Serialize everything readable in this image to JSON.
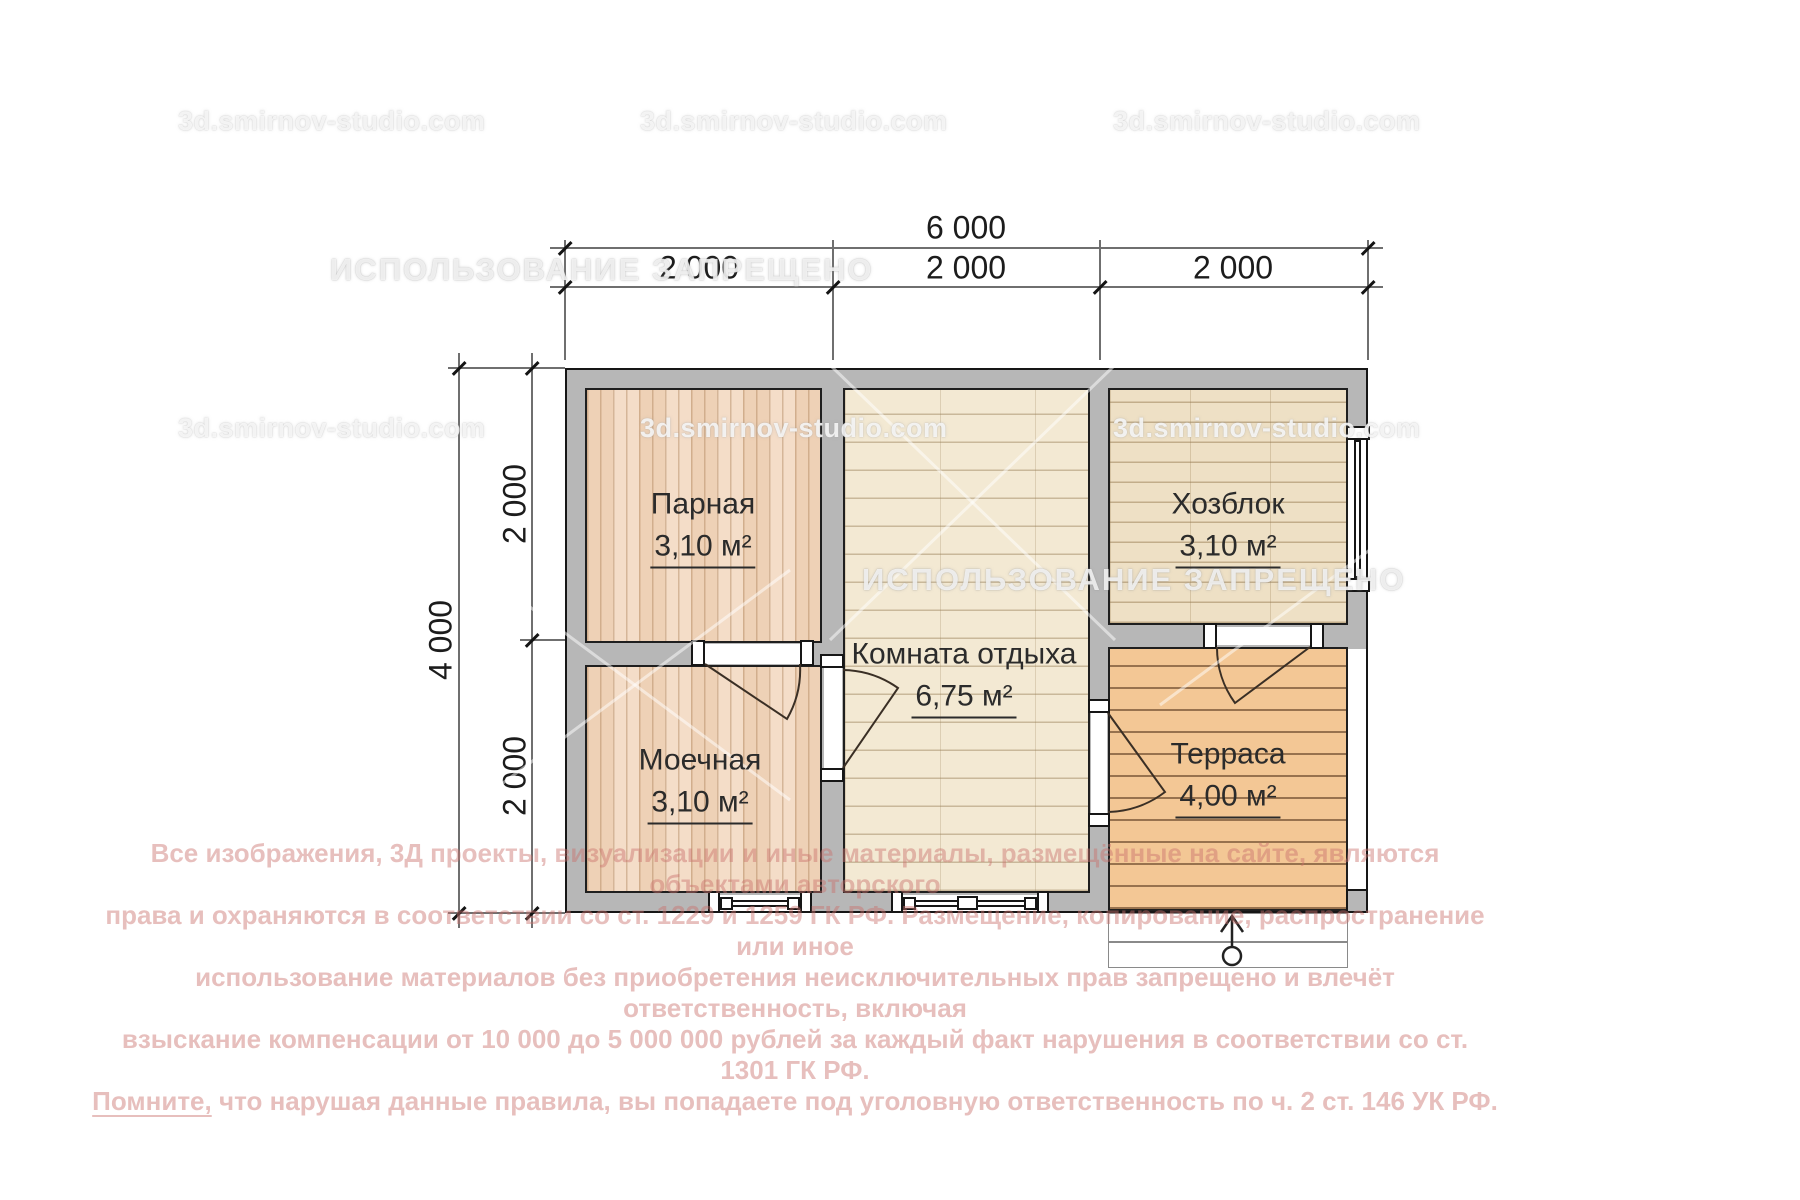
{
  "watermarks": {
    "site": "3d.smirnov-studio.com",
    "prohibition": "ИСПОЛЬЗОВАНИЕ ЗАПРЕЩЕНО"
  },
  "dimensions": {
    "total_width": "6 000",
    "width_segments": [
      "2 000",
      "2 000",
      "2 000"
    ],
    "total_height": "4 000",
    "height_segments": [
      "2 000",
      "2 000"
    ]
  },
  "rooms": [
    {
      "name": "Парная",
      "area": "3,10 м²"
    },
    {
      "name": "Моечная",
      "area": "3,10 м²"
    },
    {
      "name": "Комната отдыха",
      "area": "6,75 м²"
    },
    {
      "name": "Хозблок",
      "area": "3,10 м²"
    },
    {
      "name": "Терраса",
      "area": "4,00 м²"
    }
  ],
  "copyright": {
    "line1": "Все изображения, 3Д проекты, визуализации и иные материалы, размещённые на сайте, являются объектами авторского",
    "line2": "права и охраняются в соответствии со ст. 1229 и 1259 ГК РФ. Размещение, копирование, распространение или иное",
    "line3": "использование материалов без приобретения неисключительных прав запрещено и влечёт ответственность, включая",
    "line4": "взыскание компенсации от 10 000 до 5 000 000 рублей за каждый факт нарушения в соответствии со ст. 1301 ГК РФ.",
    "line5_lead": "Помните,",
    "line5_rest": " что нарушая данные правила, вы попадаете под уголовную ответственность по ч. 2 ст. 146 УК РФ."
  },
  "colors": {
    "wall_fill": "#b7b7b7",
    "wall_outline": "#161616",
    "floor_pine": "#f4ddc8",
    "floor_cream": "#f3e9d3",
    "floor_tan": "#eee0c5",
    "floor_deck": "#f3c795",
    "copyright_red": "rgba(201,114,108,0.45)"
  }
}
